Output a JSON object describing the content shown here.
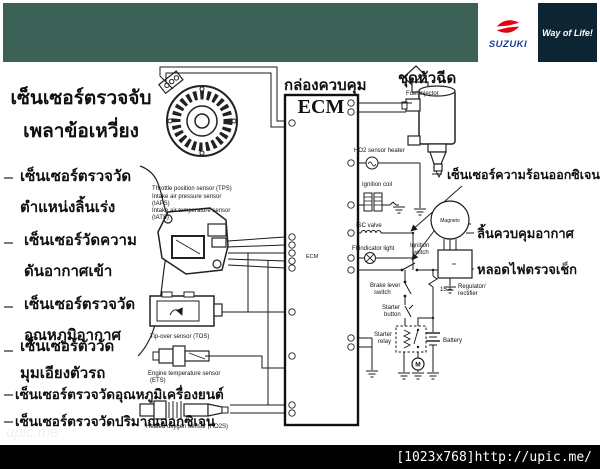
{
  "header": {
    "wordmark": "SUZUKI",
    "tagline": "Way of Life!",
    "bg": "#3c6156",
    "tagline_bg": "#0d2433",
    "logo_red": "#e60012",
    "wordmark_blue": "#1c3e92"
  },
  "footer": {
    "watermark": "[1023x768]http://upic.me/",
    "ghost": "upic.me"
  },
  "left_panel": {
    "title": {
      "line1": "เซ็นเซอร์ตรวจจับ",
      "line2": "เพลาข้อเหวี่ยง"
    },
    "items": [
      {
        "line1": "เซ็นเซอร์ตรวจวัด",
        "line2": "ตำแหน่งลิ้นเร่ง"
      },
      {
        "line1": "เซ็นเซอร์วัดความ",
        "line2": "ดันอากาศเข้า"
      },
      {
        "line1": "เซ็นเซอร์ตรวจวัด",
        "line2": "อุณหภูมิอากาศ"
      },
      {
        "line1": "เซ็นเซอร์ตัววัด",
        "line2": "มุมเอียงตัวรถ"
      },
      {
        "line1": "เซ็นเซอร์ตรวจวัดอุณหภูมิเครื่องยนต์",
        "line2": ""
      },
      {
        "line1": "เซ็นเซอร์ตรวจวัดปริมาณออกซิเจน",
        "line2": ""
      }
    ]
  },
  "diagram": {
    "ecm_box_thai": "กล่องควบคุม",
    "ecm": "ECM",
    "ecm_small": "ECM",
    "injector_thai": "ชุดหัวฉีด",
    "injector_en": "Fuel injector",
    "o2_heat_thai": "เซ็นเซอร์ความร้อนออกซิเจน",
    "air_valve_thai": "ลิ้นควบคุมอากาศ",
    "check_light_thai": "หลอดไฟตรวจเช็ก",
    "tps": "Throttle position sensor (TPS)",
    "iaps_1": "Intake air pressure sensor",
    "iaps_2": "(IAPS)",
    "iats_1": "Intake air temperature sensor",
    "iats_2": "(IATS)",
    "tos": "Tip-over sensor (TOS)",
    "ets_1": "Engine temperature sensor",
    "ets_2": "(ETS)",
    "ho2s": "Heated oxygen sensor (HO2S)",
    "ho2_heater": "HO2 sensor heater",
    "ignition_coil": "Ignition coil",
    "isc_valve": "ISC valve",
    "fi_light": "FI indicator light",
    "ignition_switch_1": "Ignition",
    "ignition_switch_2": "switch",
    "brake_1": "Brake lever",
    "brake_2": "switch",
    "starter_btn_1": "Starter",
    "starter_btn_2": "button",
    "relay_1": "Starter",
    "relay_2": "relay",
    "magneto": "Magneto",
    "fuse": "15 A",
    "battery": "Battery",
    "regulator_1": "Regulator/",
    "regulator_2": "rectifier",
    "motor": "M"
  }
}
